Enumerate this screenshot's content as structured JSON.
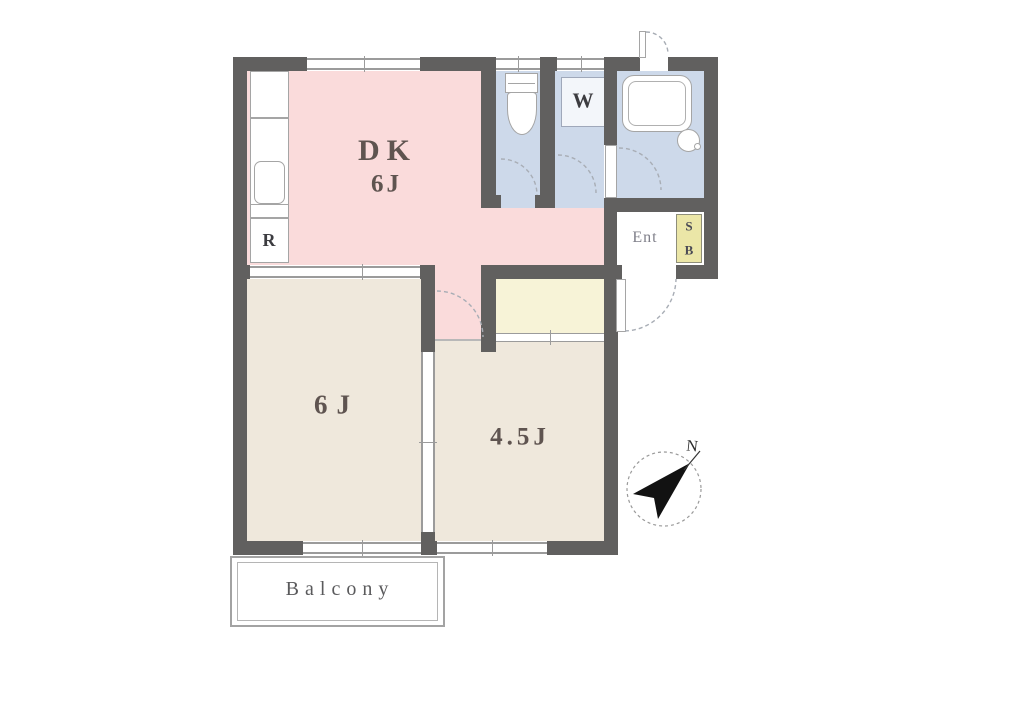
{
  "rooms": {
    "dk": {
      "name": "DK",
      "size": "6J"
    },
    "bedroom6": {
      "size": "6J"
    },
    "bedroom45": {
      "size": "4.5J"
    },
    "washer": {
      "label": "W"
    },
    "refrigerator": {
      "label": "R"
    },
    "entrance": {
      "label": "Ent"
    },
    "shoebox": {
      "letters": [
        "S",
        "B"
      ]
    },
    "balcony": {
      "label": "Balcony"
    }
  },
  "compass": {
    "label": "N"
  },
  "colors": {
    "wall": "#61605f",
    "line": "#9b9b9b",
    "door_arc": "#a8adb5",
    "dk": "#fadbdb",
    "wet": "#cdd9ea",
    "tatami": "#efe8dc",
    "closet": "#f7f3d7",
    "shoebox": "#ebe6a7",
    "ink": "#4c4145",
    "ink_soft": "#80808a",
    "balcony_line": "#a3a3a3"
  }
}
